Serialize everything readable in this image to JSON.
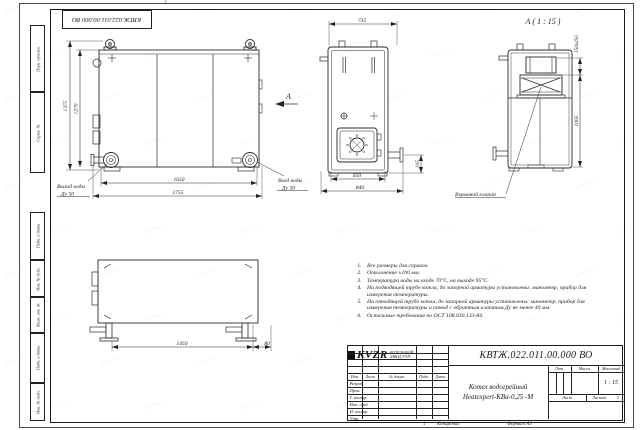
{
  "sheet": {
    "doc_number": "КВТЖ.022.011.00.000 ВО",
    "top_stamp": "КВТЖ.022.011.00.000 ВО",
    "zone_mark_top": "2",
    "bottom_mark": "1",
    "copied_label": "Копировал",
    "format_label": "Формат А3"
  },
  "frame_columns": {
    "perv_primen": "Перв. примен.",
    "sprav_no": "Справ. №",
    "podp_data_1": "Подп. и дата",
    "inv_dubl": "Инв. № дубл.",
    "vzam_inv": "Взам. инв. №",
    "podp_data_2": "Подп. и дата",
    "inv_podl": "Инв. № подл."
  },
  "views": {
    "front": {
      "dim_height_outer": "1375",
      "dim_height_inner": "1270",
      "dim_width_inner": "1650",
      "dim_width_outer": "1755",
      "outlet_label_line1": "Выход воды",
      "outlet_label_line2": "Ду 50",
      "inlet_label_line1": "Вход воды",
      "inlet_label_line2": "Ду 50",
      "view_arrow": "А"
    },
    "side": {
      "dim_top": "735",
      "dim_bottom_inner": "650",
      "dim_bottom_outer": "840",
      "dim_pipe_height": "105"
    },
    "view_a": {
      "title": "А ( 1 : 15 )",
      "dim_hatch": "150х250",
      "dim_height": "1005",
      "valve_label": "Взрывной клапан"
    },
    "top_view": {
      "dim_length": "1450",
      "dim_offset": "80"
    }
  },
  "notes": {
    "items": [
      "Все размеры для справок.",
      "Отклонение ±100 мм.",
      "Температура воды на входе 70°С, на выходе 95°С.",
      "На подводящей трубе котла, до запорной арматуры установлены: манометр, прибор для измерения температуры.",
      "На отводящей трубе котла, до запорной арматуры установлены: манометр, прибор для измерения температуры и отвод с обратным клапаном Ду не менее 40 мм.",
      "Остальные требования по ОСТ 108.030.133-84."
    ]
  },
  "title_block": {
    "doc_number": "КВТЖ.022.011.00.000 ВО",
    "columns": {
      "izm": "Изм.",
      "list": "Лист",
      "doc": "№ докум.",
      "podp": "Подп.",
      "data": "Дата"
    },
    "rows": {
      "razrab": "Разраб.",
      "prov": "Пров.",
      "tkontr": "Т. контр.",
      "nachotd": "Нач. отд.",
      "nkontr": "Н. контр.",
      "utv": "Утв."
    },
    "product_line1": "Котел водогрейный",
    "product_line2": "Heatexpert-КВа-0,25 -М",
    "lit_label": "Лит.",
    "mass_label": "Масса",
    "scale_label": "Масштаб",
    "scale_value": "1 : 15",
    "sheet_label": "Лист",
    "sheets_label": "Листов",
    "sheets_value": "1",
    "logo_text": "KVZR",
    "company_line1": "КОТЕЛЬНЫЙ",
    "company_line2": "ЗАВОД РЭП"
  },
  "watermark": {
    "text": "kvzr.ru",
    "rows": 10,
    "cols": 7
  }
}
